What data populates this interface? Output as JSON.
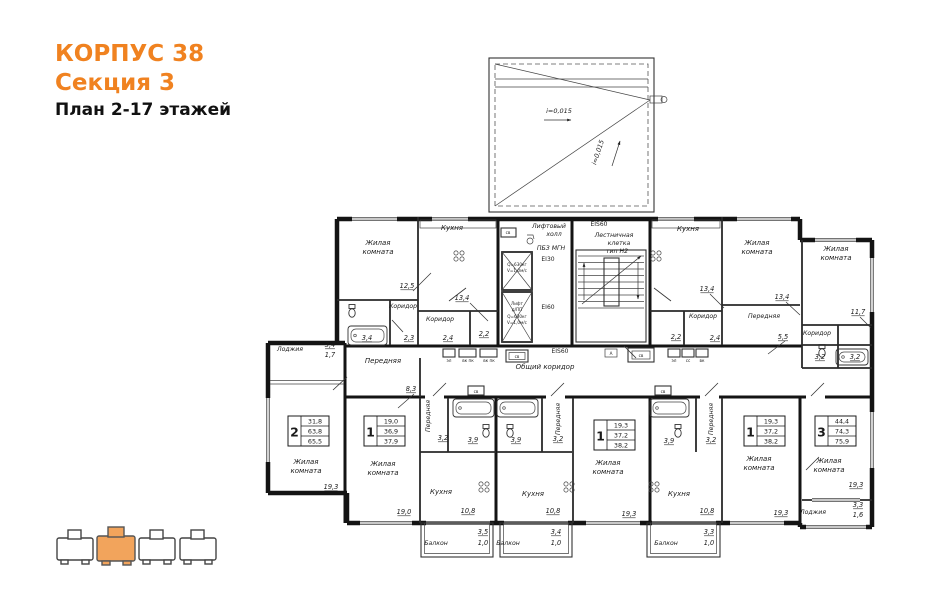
{
  "title": {
    "building": "КОРПУС 38",
    "section": "Секция 3",
    "plan": "План 2-17 этажей"
  },
  "colors": {
    "accent": "#F08220",
    "wall": "#141414",
    "keyplan_active": "#F2A45C"
  },
  "plan": {
    "stamps": [
      {
        "num": "2",
        "rows": [
          "31,8",
          "63,8",
          "65,5"
        ],
        "x": 288,
        "y": 416
      },
      {
        "num": "1",
        "rows": [
          "19,0",
          "36,9",
          "37,9"
        ],
        "x": 364,
        "y": 416
      },
      {
        "num": "1",
        "rows": [
          "19,3",
          "37,2",
          "38,2"
        ],
        "x": 594,
        "y": 420
      },
      {
        "num": "1",
        "rows": [
          "19,3",
          "37,2",
          "38,2"
        ],
        "x": 744,
        "y": 416
      },
      {
        "num": "3",
        "rows": [
          "44,4",
          "74,3",
          "75,9"
        ],
        "x": 815,
        "y": 416
      }
    ],
    "labels": [
      {
        "t": "i=0,015",
        "x": 559,
        "y": 113,
        "c": "it"
      },
      {
        "t": "i=0,015",
        "x": 600,
        "y": 153,
        "c": "it",
        "r": -72
      },
      {
        "t": "Жилая",
        "x": 378,
        "y": 245,
        "c": "room"
      },
      {
        "t": "комната",
        "x": 378,
        "y": 254,
        "c": "room"
      },
      {
        "t": "12,5",
        "x": 407,
        "y": 288,
        "c": "area"
      },
      {
        "t": "Кухня",
        "x": 452,
        "y": 230,
        "c": "room"
      },
      {
        "t": "13,4",
        "x": 462,
        "y": 300,
        "c": "area"
      },
      {
        "t": "Коридор",
        "x": 403,
        "y": 308,
        "c": "rs"
      },
      {
        "t": "2,3",
        "x": 409,
        "y": 340,
        "c": "area"
      },
      {
        "t": "Коридор",
        "x": 440,
        "y": 321,
        "c": "rs"
      },
      {
        "t": "2,4",
        "x": 448,
        "y": 340,
        "c": "area"
      },
      {
        "t": "3,4",
        "x": 367,
        "y": 340,
        "c": "area"
      },
      {
        "t": "2,2",
        "x": 484,
        "y": 336,
        "c": "area"
      },
      {
        "t": "Лифтовый",
        "x": 549,
        "y": 228,
        "c": "rs"
      },
      {
        "t": "холл",
        "x": 554,
        "y": 236,
        "c": "rs"
      },
      {
        "t": "ПБЗ МГН",
        "x": 551,
        "y": 250,
        "c": "rs"
      },
      {
        "t": "EI30",
        "x": 548,
        "y": 261,
        "c": "ei"
      },
      {
        "t": "EI60",
        "x": 548,
        "y": 309,
        "c": "ei"
      },
      {
        "t": "EIS60",
        "x": 599,
        "y": 226,
        "c": "ei"
      },
      {
        "t": "Лестничная",
        "x": 614,
        "y": 237,
        "c": "rs"
      },
      {
        "t": "клетка",
        "x": 619,
        "y": 245,
        "c": "rs"
      },
      {
        "t": "тип Н2",
        "x": 617,
        "y": 253,
        "c": "rs"
      },
      {
        "t": "EIS60",
        "x": 560,
        "y": 353,
        "c": "ei"
      },
      {
        "t": "Общий коридор",
        "x": 545,
        "y": 369,
        "c": "room"
      },
      {
        "t": "Q=630кг",
        "x": 517,
        "y": 266,
        "c": "tiny"
      },
      {
        "t": "V=1,0м/с",
        "x": 517,
        "y": 272,
        "c": "tiny"
      },
      {
        "t": "Лифт",
        "x": 517,
        "y": 305,
        "c": "tiny"
      },
      {
        "t": "д/ПП",
        "x": 517,
        "y": 311,
        "c": "tiny"
      },
      {
        "t": "Q=630кг",
        "x": 517,
        "y": 318,
        "c": "tiny"
      },
      {
        "t": "V=1,0м/с",
        "x": 517,
        "y": 324,
        "c": "tiny"
      },
      {
        "t": "Кухня",
        "x": 688,
        "y": 231,
        "c": "room"
      },
      {
        "t": "13,4",
        "x": 707,
        "y": 291,
        "c": "area"
      },
      {
        "t": "Жилая",
        "x": 757,
        "y": 245,
        "c": "room"
      },
      {
        "t": "комната",
        "x": 757,
        "y": 254,
        "c": "room"
      },
      {
        "t": "13,4",
        "x": 782,
        "y": 299,
        "c": "area"
      },
      {
        "t": "Передняя",
        "x": 764,
        "y": 318,
        "c": "rs"
      },
      {
        "t": "5,5",
        "x": 783,
        "y": 339,
        "c": "area"
      },
      {
        "t": "Коридор",
        "x": 703,
        "y": 318,
        "c": "rs"
      },
      {
        "t": "2,2",
        "x": 676,
        "y": 339,
        "c": "area"
      },
      {
        "t": "2,4",
        "x": 715,
        "y": 340,
        "c": "area"
      },
      {
        "t": "Жилая",
        "x": 836,
        "y": 251,
        "c": "room"
      },
      {
        "t": "комната",
        "x": 836,
        "y": 260,
        "c": "room"
      },
      {
        "t": "11,7",
        "x": 858,
        "y": 314,
        "c": "area"
      },
      {
        "t": "Коридор",
        "x": 817,
        "y": 335,
        "c": "rs"
      },
      {
        "t": "3,2",
        "x": 820,
        "y": 359,
        "c": "area"
      },
      {
        "t": "3,2",
        "x": 855,
        "y": 359,
        "c": "area"
      },
      {
        "t": "Лоджия",
        "x": 290,
        "y": 351,
        "c": "rs"
      },
      {
        "t": "3,4",
        "x": 330,
        "y": 347,
        "c": "area"
      },
      {
        "t": "1,7",
        "x": 330,
        "y": 357,
        "c": "ap"
      },
      {
        "t": "Передняя",
        "x": 383,
        "y": 363,
        "c": "room"
      },
      {
        "t": "8,3",
        "x": 411,
        "y": 391,
        "c": "area"
      },
      {
        "t": "Жилая",
        "x": 306,
        "y": 464,
        "c": "room"
      },
      {
        "t": "комната",
        "x": 306,
        "y": 473,
        "c": "room"
      },
      {
        "t": "19,3",
        "x": 331,
        "y": 489,
        "c": "area"
      },
      {
        "t": "Жилая",
        "x": 383,
        "y": 466,
        "c": "room"
      },
      {
        "t": "комната",
        "x": 383,
        "y": 475,
        "c": "room"
      },
      {
        "t": "19,0",
        "x": 404,
        "y": 514,
        "c": "area"
      },
      {
        "t": "Передняя",
        "x": 430,
        "y": 416,
        "c": "rs",
        "r": -90
      },
      {
        "t": "3,2",
        "x": 443,
        "y": 440,
        "c": "area"
      },
      {
        "t": "3,9",
        "x": 473,
        "y": 442,
        "c": "area"
      },
      {
        "t": "Кухня",
        "x": 441,
        "y": 494,
        "c": "room"
      },
      {
        "t": "10,8",
        "x": 468,
        "y": 513,
        "c": "area"
      },
      {
        "t": "Балкон",
        "x": 436,
        "y": 545,
        "c": "rs"
      },
      {
        "t": "3,5",
        "x": 483,
        "y": 534,
        "c": "area"
      },
      {
        "t": "1,0",
        "x": 483,
        "y": 545,
        "c": "ap"
      },
      {
        "t": "3,9",
        "x": 516,
        "y": 442,
        "c": "area"
      },
      {
        "t": "3,2",
        "x": 558,
        "y": 441,
        "c": "area"
      },
      {
        "t": "Передняя",
        "x": 560,
        "y": 419,
        "c": "rs",
        "r": -90
      },
      {
        "t": "Кухня",
        "x": 533,
        "y": 496,
        "c": "room"
      },
      {
        "t": "10,8",
        "x": 553,
        "y": 513,
        "c": "area"
      },
      {
        "t": "Жилая",
        "x": 608,
        "y": 465,
        "c": "room"
      },
      {
        "t": "комната",
        "x": 608,
        "y": 474,
        "c": "room"
      },
      {
        "t": "19,3",
        "x": 629,
        "y": 516,
        "c": "area"
      },
      {
        "t": "Балкон",
        "x": 508,
        "y": 545,
        "c": "rs"
      },
      {
        "t": "3,4",
        "x": 556,
        "y": 534,
        "c": "area"
      },
      {
        "t": "1,0",
        "x": 556,
        "y": 545,
        "c": "ap"
      },
      {
        "t": "3,9",
        "x": 669,
        "y": 443,
        "c": "area"
      },
      {
        "t": "3,2",
        "x": 711,
        "y": 442,
        "c": "area"
      },
      {
        "t": "Передняя",
        "x": 713,
        "y": 419,
        "c": "rs",
        "r": -90
      },
      {
        "t": "Кухня",
        "x": 679,
        "y": 496,
        "c": "room"
      },
      {
        "t": "10,8",
        "x": 707,
        "y": 513,
        "c": "area"
      },
      {
        "t": "Жилая",
        "x": 759,
        "y": 461,
        "c": "room"
      },
      {
        "t": "комната",
        "x": 759,
        "y": 470,
        "c": "room"
      },
      {
        "t": "19,3",
        "x": 781,
        "y": 515,
        "c": "area"
      },
      {
        "t": "Балкон",
        "x": 666,
        "y": 545,
        "c": "rs"
      },
      {
        "t": "3,3",
        "x": 709,
        "y": 534,
        "c": "area"
      },
      {
        "t": "1,0",
        "x": 709,
        "y": 545,
        "c": "ap"
      },
      {
        "t": "Жилая",
        "x": 829,
        "y": 463,
        "c": "room"
      },
      {
        "t": "комната",
        "x": 829,
        "y": 472,
        "c": "room"
      },
      {
        "t": "19,3",
        "x": 856,
        "y": 487,
        "c": "area"
      },
      {
        "t": "Лоджия",
        "x": 813,
        "y": 514,
        "c": "rs"
      },
      {
        "t": "3,3",
        "x": 858,
        "y": 507,
        "c": "area"
      },
      {
        "t": "1,6",
        "x": 858,
        "y": 517,
        "c": "ap"
      },
      {
        "t": "эл",
        "x": 449,
        "y": 362,
        "c": "tiny"
      },
      {
        "t": "вк пк",
        "x": 468,
        "y": 362,
        "c": "tiny"
      },
      {
        "t": "вк пк",
        "x": 489,
        "y": 362,
        "c": "tiny"
      },
      {
        "t": "св",
        "x": 517,
        "y": 358,
        "c": "tiny"
      },
      {
        "t": "А",
        "x": 611,
        "y": 355,
        "c": "tiny"
      },
      {
        "t": "св",
        "x": 641,
        "y": 357,
        "c": "tiny"
      },
      {
        "t": "эл",
        "x": 674,
        "y": 362,
        "c": "tiny"
      },
      {
        "t": "сс",
        "x": 688,
        "y": 362,
        "c": "tiny"
      },
      {
        "t": "вк",
        "x": 702,
        "y": 362,
        "c": "tiny"
      },
      {
        "t": "св",
        "x": 508,
        "y": 234,
        "c": "tiny"
      },
      {
        "t": "св",
        "x": 476,
        "y": 393,
        "c": "tiny"
      },
      {
        "t": "св",
        "x": 663,
        "y": 393,
        "c": "tiny"
      }
    ]
  }
}
